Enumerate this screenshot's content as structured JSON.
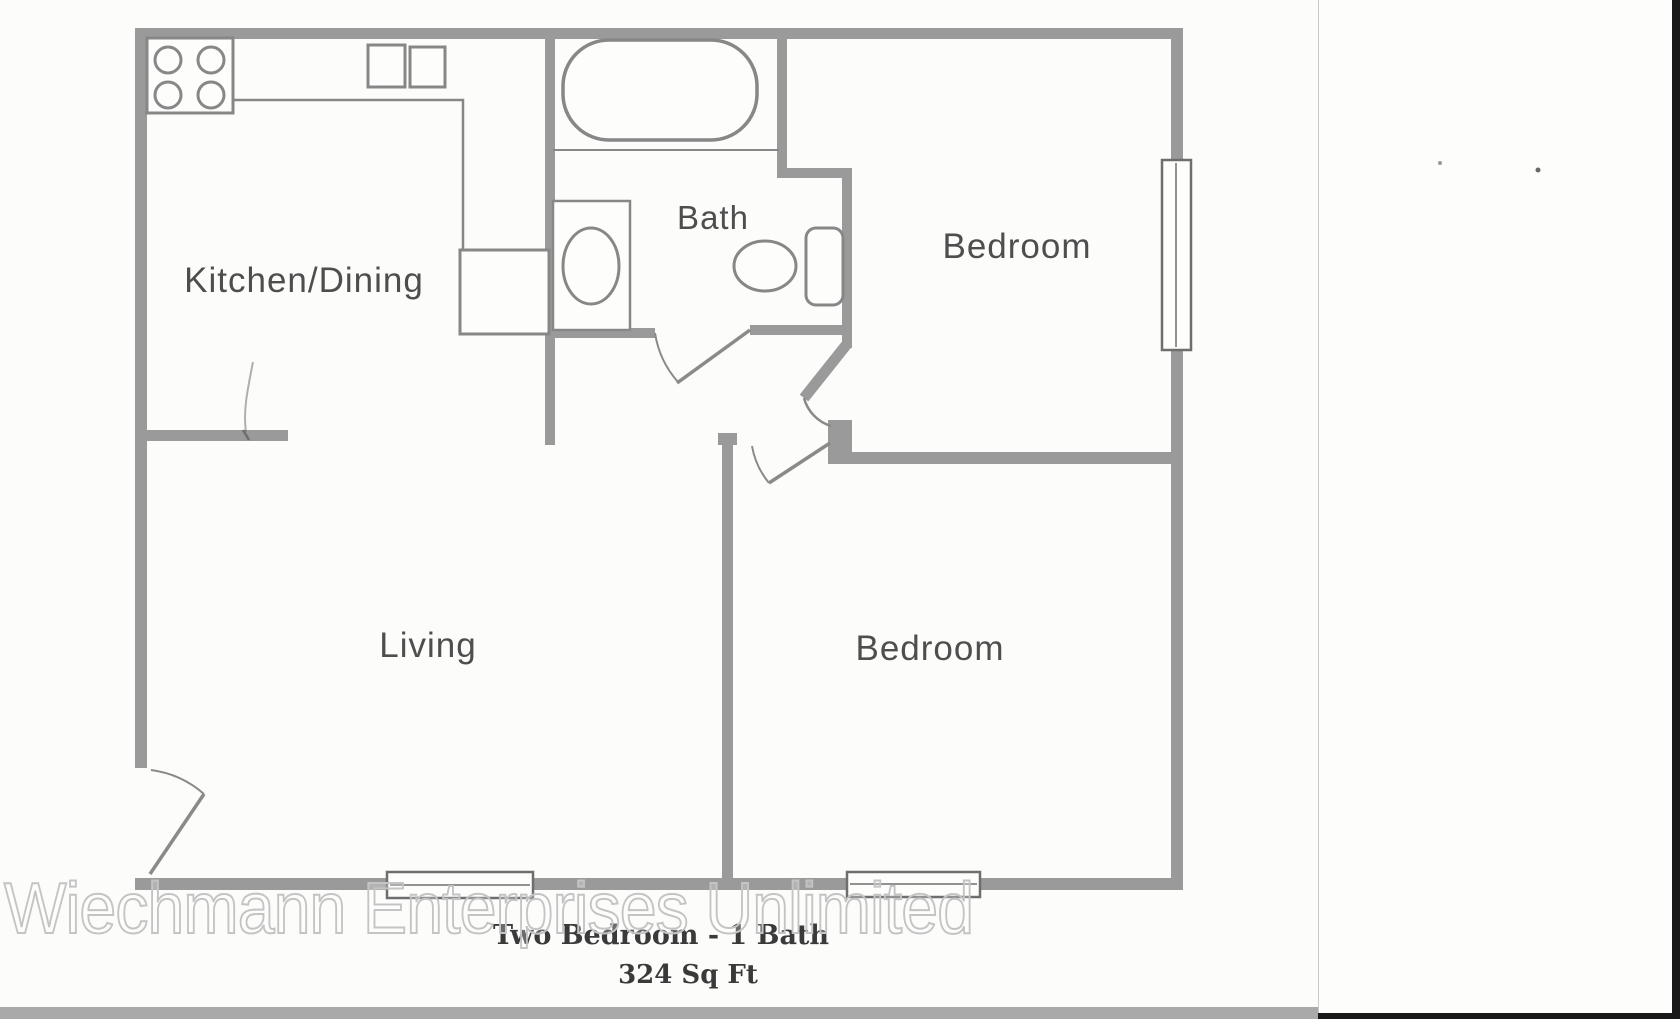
{
  "floorplan": {
    "rooms": {
      "kitchen": {
        "label": "Kitchen/Dining"
      },
      "bath": {
        "label": "Bath"
      },
      "bedroom_top": {
        "label": "Bedroom"
      },
      "living": {
        "label": "Living"
      },
      "bedroom_bottom": {
        "label": "Bedroom"
      }
    },
    "fixtures": {
      "stove": "stove-4-burners",
      "kitchen_sink": "double-basin-sink",
      "refrigerator": "refrigerator-box",
      "bathtub": "bathtub",
      "vanity": "vanity-with-oval-sink",
      "toilet": "toilet-with-tank",
      "windows": [
        "bedroom-top-right-window",
        "living-bottom-window",
        "bedroom-bottom-window"
      ],
      "doors": [
        "entry-door",
        "bath-door",
        "bedroom-top-door",
        "bedroom-bottom-door"
      ]
    },
    "colors": {
      "wall": "#9a9a9a",
      "fixture_line": "#878787",
      "label_text": "#4e4e4e",
      "title_text": "#3a3a3a",
      "watermark": "#c4c4c4",
      "paper": "#fcfcfb",
      "scan_border": "#191919"
    }
  },
  "caption": {
    "title": "Two Bedroom - 1 Bath",
    "area": "324 Sq Ft"
  },
  "watermark": {
    "text": "Wiechmann Enterprises Unlimited"
  }
}
